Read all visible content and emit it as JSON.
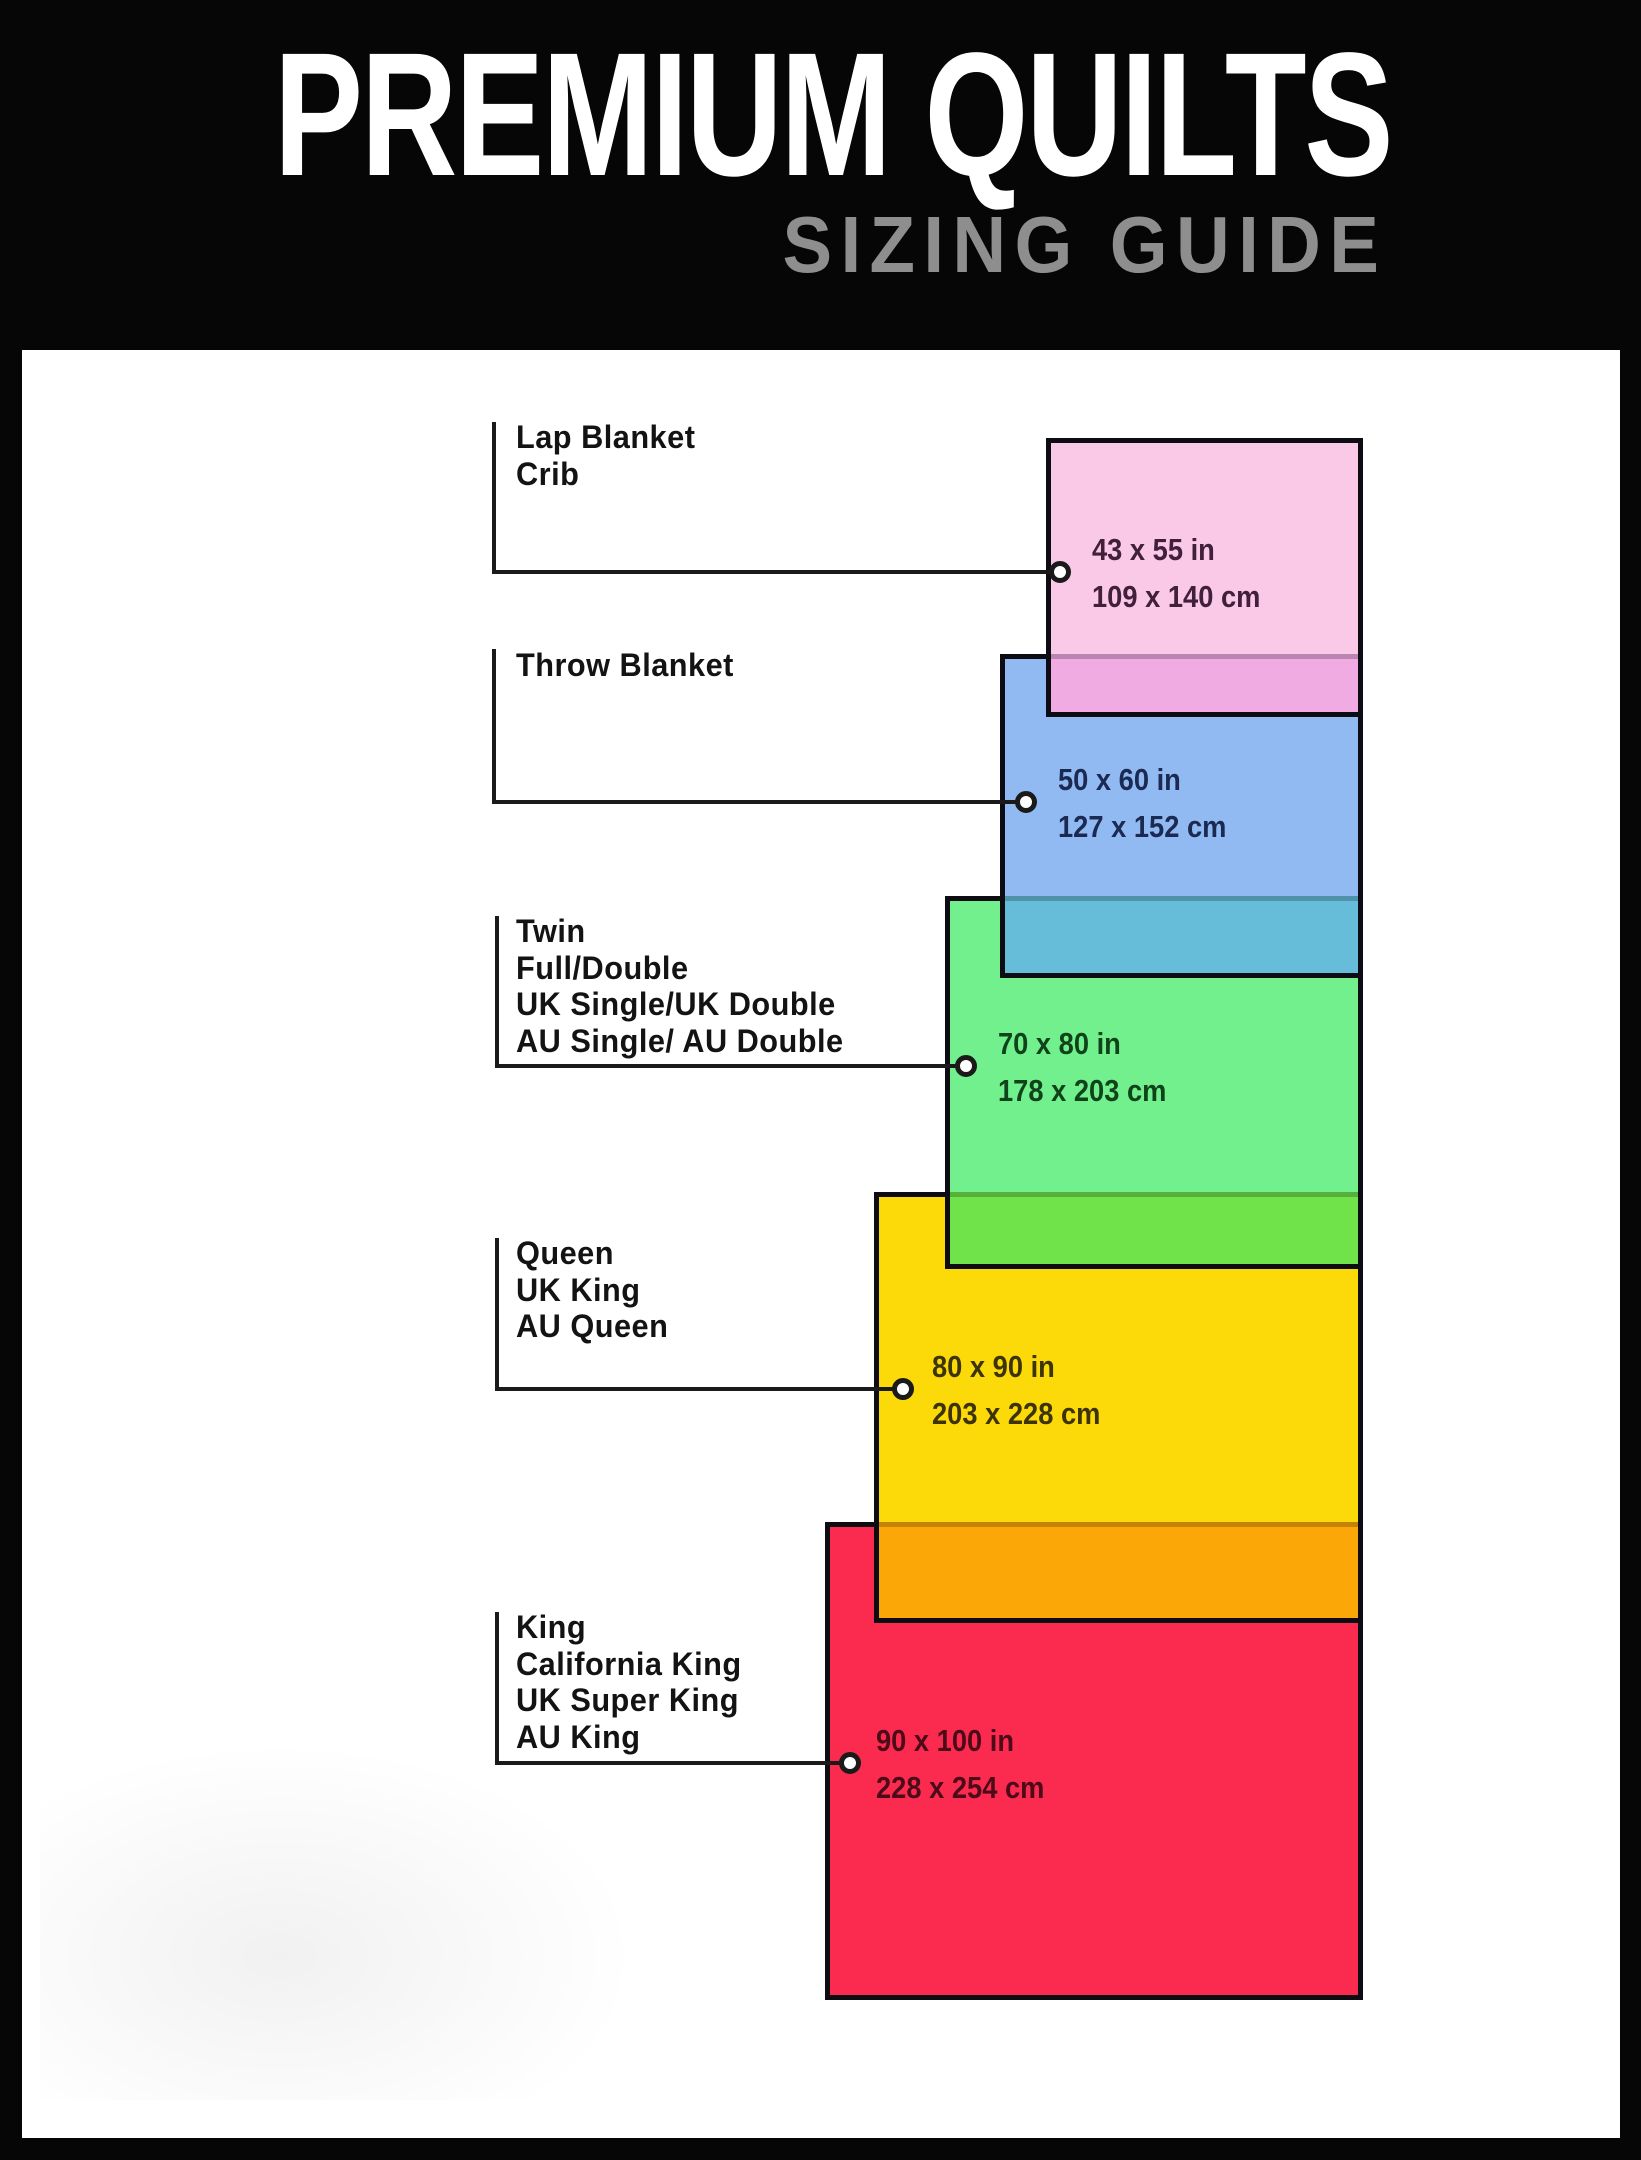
{
  "header": {
    "title": "PREMIUM QUILTS",
    "subtitle": "SIZING GUIDE",
    "title_color": "#ffffff",
    "subtitle_color": "#8e8e8e"
  },
  "background": "#060606",
  "panel_background": "#ffffff",
  "line_color": "#1a1a1a",
  "border_color": "#0c0c12",
  "sizes": [
    {
      "label": "Lap Blanket\nCrib",
      "inches": "43 x 55 in",
      "cm": "109 x 140 cm",
      "fill": "#fbc9e8",
      "overlap_fill": "#f0abe3",
      "text_color": "#41203c"
    },
    {
      "label": "Throw Blanket",
      "inches": "50 x 60 in",
      "cm": "127 x 152 cm",
      "fill": "#92baf2",
      "overlap_fill": "#65bdda",
      "text_color": "#1a2a52"
    },
    {
      "label": "Twin\nFull/Double\nUK Single/UK Double\nAU Single/ AU Double",
      "inches": "70 x 80 in",
      "cm": "178 x 203 cm",
      "fill": "#71f08d",
      "overlap_fill": "#70e24a",
      "text_color": "#11431b"
    },
    {
      "label": "Queen\nUK King\nAU Queen",
      "inches": "80 x 90 in",
      "cm": "203 x 228 cm",
      "fill": "#fcd908",
      "overlap_fill": "#fba708",
      "text_color": "#3c3406"
    },
    {
      "label": "King\nCalifornia King\nUK Super King\nAU King",
      "inches": "90 x 100 in",
      "cm": "228 x 254 cm",
      "fill": "#fb2b50",
      "overlap_fill": null,
      "text_color": "#4d0b1a"
    }
  ]
}
